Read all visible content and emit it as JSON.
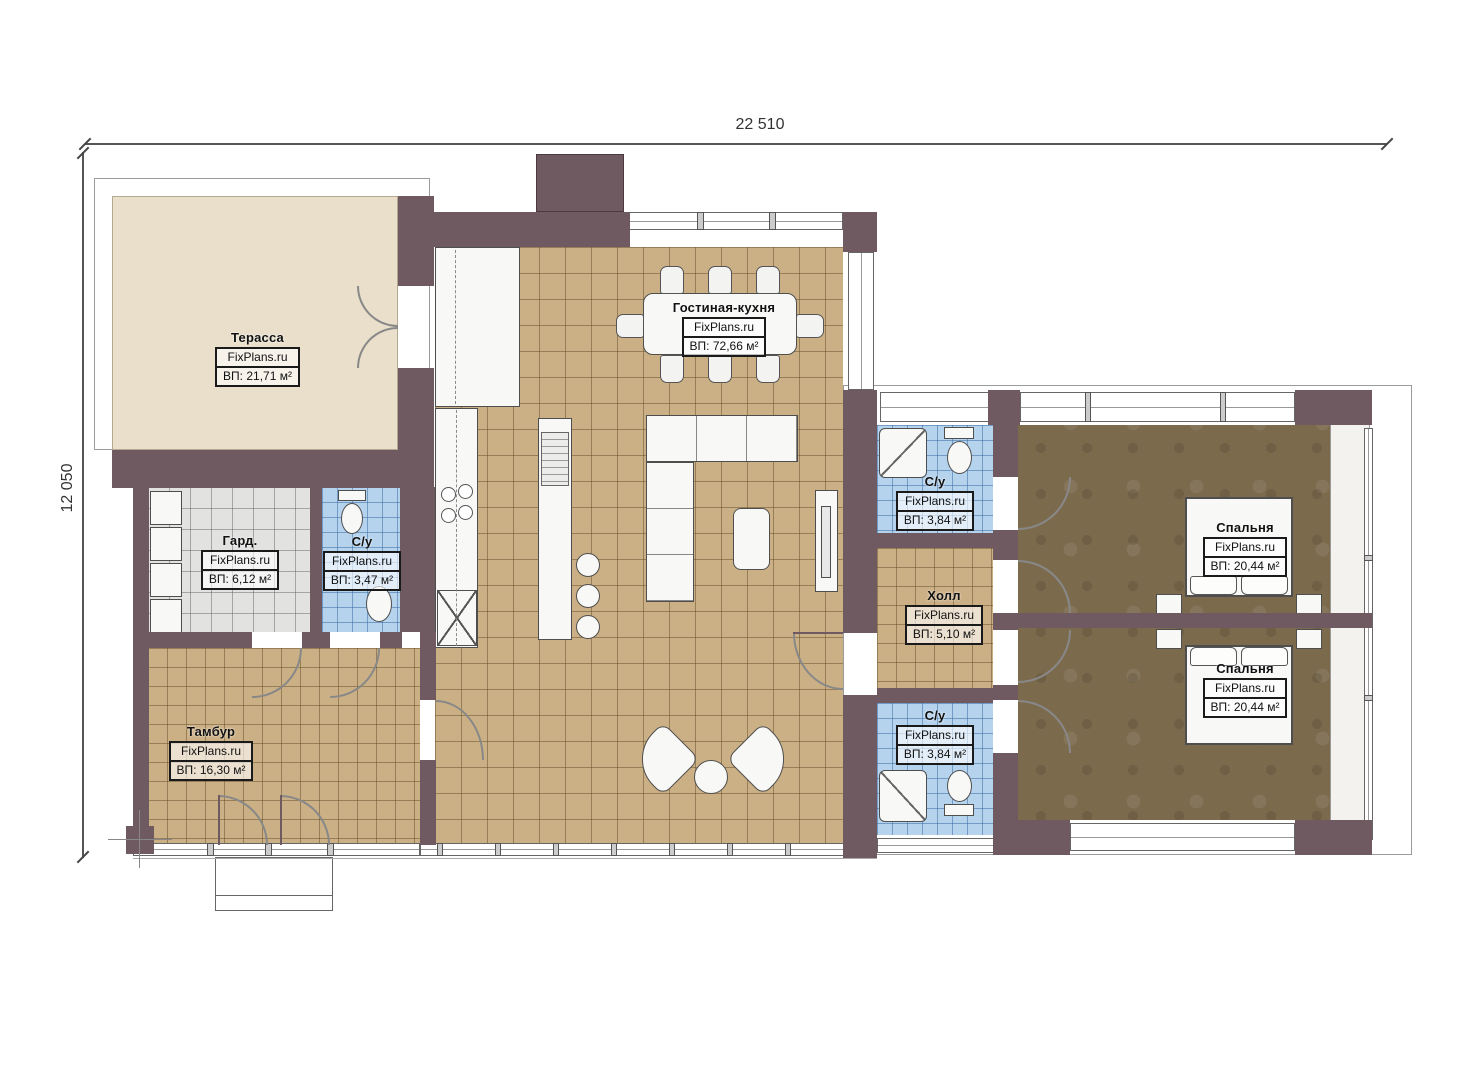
{
  "plan": {
    "title": "floor-plan",
    "watermark": "FixPlans.ru",
    "dimensions": {
      "width_label": "22 510",
      "height_label": "12 050"
    },
    "rooms": [
      {
        "name": "Терасса",
        "area": "ВП: 21,71 м²"
      },
      {
        "name": "Гостиная-кухня",
        "area": "ВП: 72,66 м²"
      },
      {
        "name": "Гард.",
        "area": "ВП: 6,12 м²"
      },
      {
        "name": "С/у",
        "area": "ВП: 3,47 м²"
      },
      {
        "name": "Тамбур",
        "area": "ВП: 16,30 м²"
      },
      {
        "name": "С/у",
        "area": "ВП: 3,84 м²"
      },
      {
        "name": "Холл",
        "area": "ВП: 5,10 м²"
      },
      {
        "name": "С/у",
        "area": "ВП: 3,84 м²"
      },
      {
        "name": "Спальня",
        "area": "ВП: 20,44 м²"
      },
      {
        "name": "Спальня",
        "area": "ВП: 20,44 м²"
      }
    ],
    "colors": {
      "wall": "#6e5a60",
      "floor_tile": "#ccb085",
      "bathroom_tile": "#b6d3ee",
      "wardrobe_tile": "#e2e2e1",
      "bedroom_floor": "#7c6a4d",
      "terrace_floor": "#e9dfcb"
    }
  }
}
